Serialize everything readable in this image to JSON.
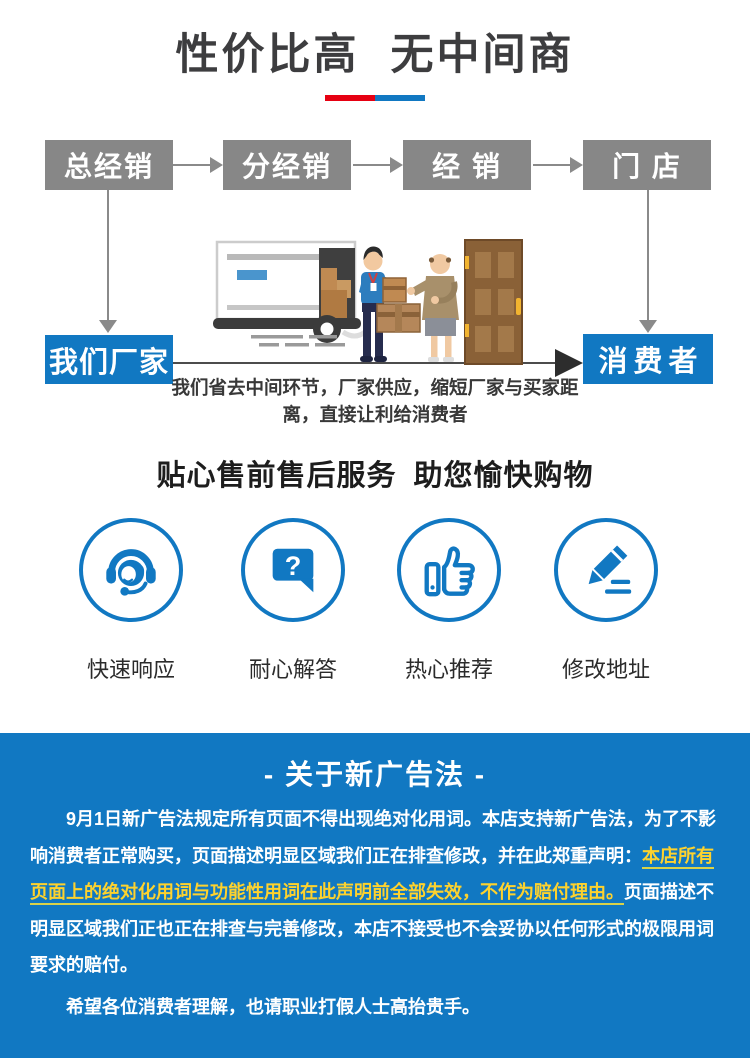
{
  "colors": {
    "blue": "#1178c2",
    "red": "#e60012",
    "yellow": "#fdd22e",
    "gray_box": "#878787"
  },
  "header": {
    "title": "性价比高 无中间商"
  },
  "flow": {
    "top_boxes": [
      "总经销",
      "分经销",
      "经 销",
      "门 店"
    ],
    "left_box": "我们厂家",
    "right_box": "消费者",
    "caption_lines": [
      "我们省去中间环节，厂家供应，缩短厂家与买家距",
      "离，直接让利给消费者"
    ]
  },
  "services": {
    "title": "贴心售前售后服务 助您愉快购物",
    "items": [
      {
        "icon": "headset-icon",
        "label": "快速响应"
      },
      {
        "icon": "question-bubble-icon",
        "label": "耐心解答"
      },
      {
        "icon": "thumb-up-icon",
        "label": "热心推荐"
      },
      {
        "icon": "pencil-icon",
        "label": "修改地址"
      }
    ]
  },
  "notice": {
    "title": "- 关于新广告法 -",
    "lines": [
      {
        "indent": true,
        "para_gap": false,
        "segments": [
          {
            "text": "9月1日新广告法规定所有页面不得出现绝对化用词。本店支持新广告法，为了不影",
            "hl": false
          }
        ]
      },
      {
        "indent": false,
        "para_gap": false,
        "segments": [
          {
            "text": "响消费者正常购买，页面描述明显区域我们正在排查修改，并在此郑重声明：",
            "hl": false
          },
          {
            "text": "本店所有",
            "hl": true
          }
        ]
      },
      {
        "indent": false,
        "para_gap": false,
        "segments": [
          {
            "text": "页面上的绝对化用词与功能性用词在此声明前全部失效，不作为赔付理由。",
            "hl": true
          },
          {
            "text": "页面描述不",
            "hl": false
          }
        ]
      },
      {
        "indent": false,
        "para_gap": false,
        "segments": [
          {
            "text": "明显区域我们正也正在排查与完善修改，本店不接受也不会妥协以任何形式的极限用词",
            "hl": false
          }
        ]
      },
      {
        "indent": false,
        "para_gap": false,
        "segments": [
          {
            "text": "要求的赔付。",
            "hl": false
          }
        ]
      },
      {
        "indent": true,
        "para_gap": true,
        "segments": [
          {
            "text": "希望各位消费者理解，也请职业打假人士高抬贵手。",
            "hl": false
          }
        ]
      }
    ]
  }
}
